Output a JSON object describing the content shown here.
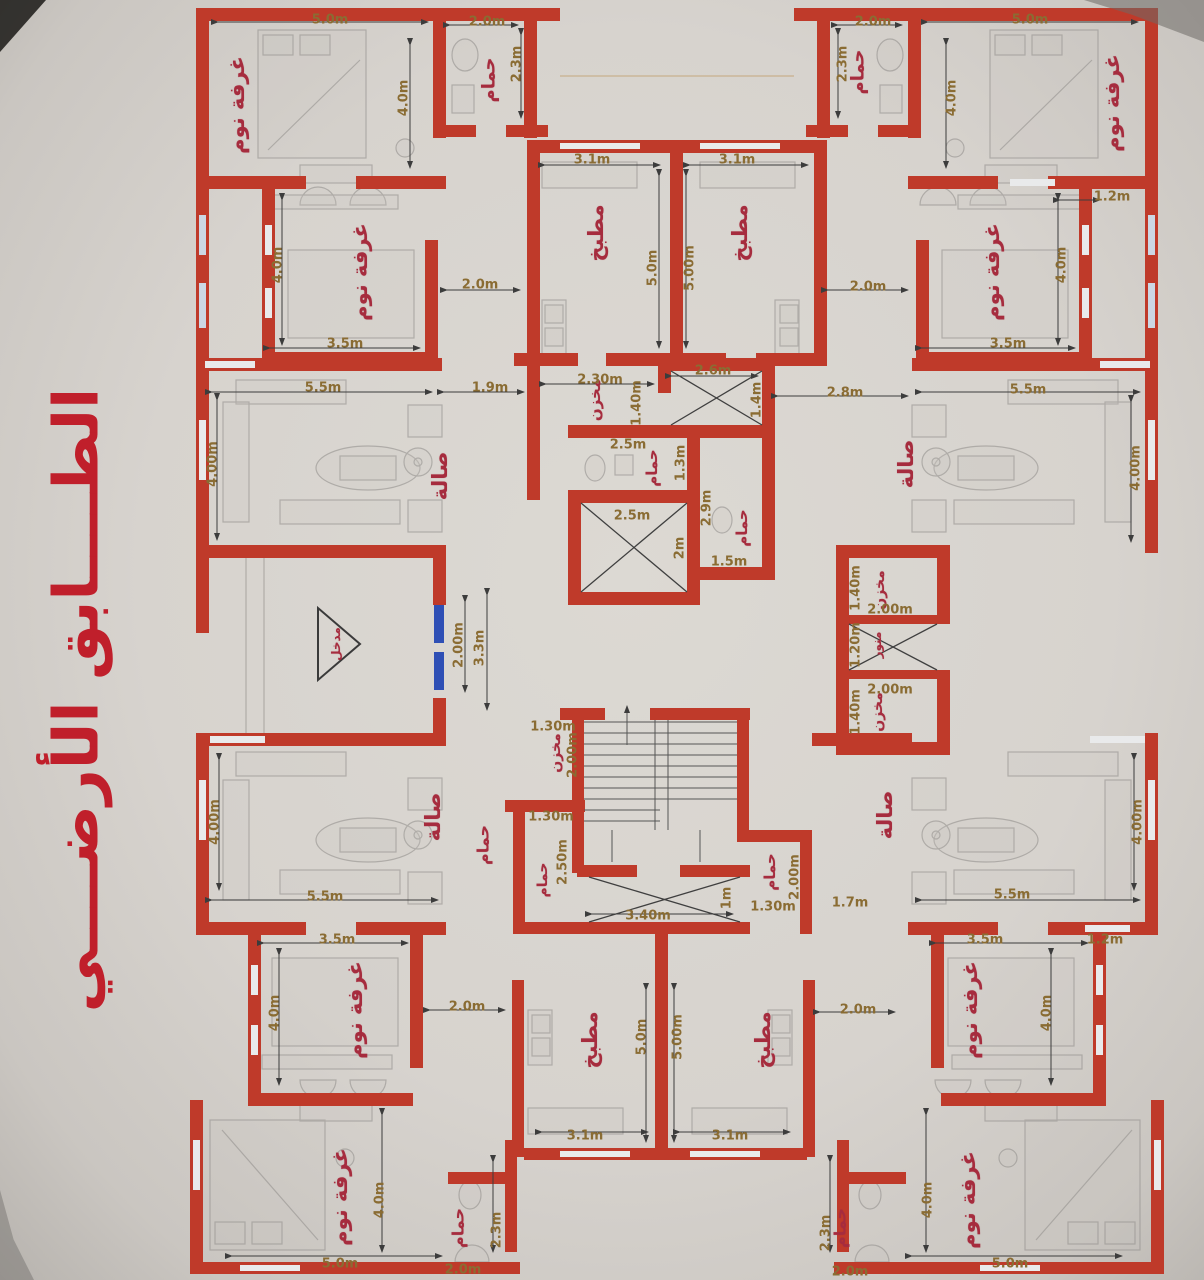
{
  "title": {
    "text": "الطــــابق الأرضــــي"
  },
  "colors": {
    "wall": "#bf3a2a",
    "room_label": "#a62c3e",
    "dim_label": "#8a6c33",
    "title": "#c01f2b",
    "door": "#2e4fb5",
    "paper": "#d7d3ce"
  },
  "rooms": [
    {
      "t": "غرفة نوم",
      "x": 237,
      "y": 105,
      "r": -90
    },
    {
      "t": "حمام",
      "x": 489,
      "y": 80,
      "r": -90,
      "s": 18
    },
    {
      "t": "غرفة نوم",
      "x": 360,
      "y": 272,
      "r": -90
    },
    {
      "t": "مطبخ",
      "x": 596,
      "y": 233,
      "r": -90
    },
    {
      "t": "مطبخ",
      "x": 740,
      "y": 233,
      "r": -90
    },
    {
      "t": "حمام",
      "x": 858,
      "y": 72,
      "r": -90,
      "s": 18
    },
    {
      "t": "غرفة نوم",
      "x": 1112,
      "y": 103,
      "r": -90
    },
    {
      "t": "غرفة نوم",
      "x": 992,
      "y": 272,
      "r": -90
    },
    {
      "t": "صالة",
      "x": 440,
      "y": 476,
      "r": -90
    },
    {
      "t": "صالة",
      "x": 906,
      "y": 464,
      "r": -90
    },
    {
      "t": "مخزن",
      "x": 595,
      "y": 400,
      "r": -90,
      "s": 15
    },
    {
      "t": "حمام",
      "x": 652,
      "y": 468,
      "r": -90,
      "s": 15
    },
    {
      "t": "حمام",
      "x": 742,
      "y": 528,
      "r": -90,
      "s": 15
    },
    {
      "t": "مخزن",
      "x": 880,
      "y": 590,
      "r": -90,
      "s": 14
    },
    {
      "t": "منور",
      "x": 877,
      "y": 645,
      "r": -90,
      "s": 12
    },
    {
      "t": "مخزن",
      "x": 878,
      "y": 712,
      "r": -90,
      "s": 14
    },
    {
      "t": "مدخل",
      "x": 336,
      "y": 644,
      "r": -90,
      "s": 12
    },
    {
      "t": "مخزن",
      "x": 556,
      "y": 753,
      "r": -90,
      "s": 14
    },
    {
      "t": "حمام",
      "x": 483,
      "y": 845,
      "r": -90,
      "s": 16
    },
    {
      "t": "حمام",
      "x": 543,
      "y": 880,
      "r": -90,
      "s": 14
    },
    {
      "t": "حمام",
      "x": 770,
      "y": 872,
      "r": -90,
      "s": 15
    },
    {
      "t": "صالة",
      "x": 433,
      "y": 817,
      "r": -90
    },
    {
      "t": "صالة",
      "x": 885,
      "y": 815,
      "r": -90
    },
    {
      "t": "غرفة نوم",
      "x": 355,
      "y": 1010,
      "r": -90
    },
    {
      "t": "غرفة نوم",
      "x": 970,
      "y": 1010,
      "r": -90
    },
    {
      "t": "مطبخ",
      "x": 590,
      "y": 1040,
      "r": -90
    },
    {
      "t": "مطبخ",
      "x": 763,
      "y": 1040,
      "r": -90
    },
    {
      "t": "غرفة نوم",
      "x": 340,
      "y": 1197,
      "r": -90
    },
    {
      "t": "غرفة نوم",
      "x": 968,
      "y": 1200,
      "r": -90
    },
    {
      "t": "حمام",
      "x": 458,
      "y": 1228,
      "r": -90,
      "s": 16
    },
    {
      "t": "حمام",
      "x": 840,
      "y": 1228,
      "r": -90,
      "s": 16
    }
  ],
  "dimensions": [
    {
      "t": "5.0m",
      "x": 330,
      "y": 20,
      "r": 0
    },
    {
      "t": "2.0m",
      "x": 487,
      "y": 22,
      "r": 0
    },
    {
      "t": "2.3m",
      "x": 517,
      "y": 64,
      "r": -90
    },
    {
      "t": "4.0m",
      "x": 404,
      "y": 98,
      "r": -90
    },
    {
      "t": "2.0m",
      "x": 873,
      "y": 22,
      "r": 0
    },
    {
      "t": "5.0m",
      "x": 1030,
      "y": 20,
      "r": 0
    },
    {
      "t": "2.3m",
      "x": 843,
      "y": 64,
      "r": -90
    },
    {
      "t": "4.0m",
      "x": 952,
      "y": 98,
      "r": -90
    },
    {
      "t": "1.2m",
      "x": 1112,
      "y": 197,
      "r": 0
    },
    {
      "t": "3.1m",
      "x": 592,
      "y": 160,
      "r": 0
    },
    {
      "t": "3.1m",
      "x": 737,
      "y": 160,
      "r": 0
    },
    {
      "t": "5.0m",
      "x": 653,
      "y": 268,
      "r": -90
    },
    {
      "t": "5.00m",
      "x": 690,
      "y": 268,
      "r": -90
    },
    {
      "t": "4.0m",
      "x": 278,
      "y": 265,
      "r": -90
    },
    {
      "t": "2.0m",
      "x": 480,
      "y": 285,
      "r": 0
    },
    {
      "t": "2.0m",
      "x": 868,
      "y": 287,
      "r": 0
    },
    {
      "t": "4.0m",
      "x": 1062,
      "y": 265,
      "r": -90
    },
    {
      "t": "3.5m",
      "x": 345,
      "y": 344,
      "r": 0
    },
    {
      "t": "3.5m",
      "x": 1008,
      "y": 344,
      "r": 0
    },
    {
      "t": "5.5m",
      "x": 323,
      "y": 388,
      "r": 0
    },
    {
      "t": "1.9m",
      "x": 490,
      "y": 388,
      "r": 0
    },
    {
      "t": "2.30m",
      "x": 600,
      "y": 380,
      "r": 0
    },
    {
      "t": "1.40m",
      "x": 637,
      "y": 403,
      "r": -90
    },
    {
      "t": "2.6m",
      "x": 713,
      "y": 371,
      "r": 0
    },
    {
      "t": "1.4m",
      "x": 757,
      "y": 400,
      "r": -90
    },
    {
      "t": "2.8m",
      "x": 845,
      "y": 393,
      "r": 0
    },
    {
      "t": "5.5m",
      "x": 1028,
      "y": 390,
      "r": 0
    },
    {
      "t": "4.00m",
      "x": 213,
      "y": 464,
      "r": -90
    },
    {
      "t": "4.00m",
      "x": 1136,
      "y": 468,
      "r": -90
    },
    {
      "t": "2.5m",
      "x": 628,
      "y": 445,
      "r": 0
    },
    {
      "t": "1.3m",
      "x": 681,
      "y": 463,
      "r": -90
    },
    {
      "t": "2.9m",
      "x": 707,
      "y": 508,
      "r": -90
    },
    {
      "t": "2.5m",
      "x": 632,
      "y": 516,
      "r": 0
    },
    {
      "t": "2m",
      "x": 680,
      "y": 548,
      "r": -90
    },
    {
      "t": "1.5m",
      "x": 729,
      "y": 562,
      "r": 0
    },
    {
      "t": "1.40m",
      "x": 856,
      "y": 588,
      "r": -90
    },
    {
      "t": "2.00m",
      "x": 890,
      "y": 610,
      "r": 0
    },
    {
      "t": "1.20m",
      "x": 856,
      "y": 645,
      "r": -90
    },
    {
      "t": "2.00m",
      "x": 890,
      "y": 690,
      "r": 0
    },
    {
      "t": "1.40m",
      "x": 856,
      "y": 712,
      "r": -90
    },
    {
      "t": "2.00m",
      "x": 459,
      "y": 645,
      "r": -90
    },
    {
      "t": "3.3m",
      "x": 480,
      "y": 648,
      "r": -90
    },
    {
      "t": "1.30m",
      "x": 553,
      "y": 727,
      "r": 0
    },
    {
      "t": "2.00m",
      "x": 573,
      "y": 755,
      "r": -90
    },
    {
      "t": "1.30m",
      "x": 551,
      "y": 817,
      "r": 0
    },
    {
      "t": "2.50m",
      "x": 563,
      "y": 862,
      "r": -90
    },
    {
      "t": "3.40m",
      "x": 648,
      "y": 916,
      "r": 0
    },
    {
      "t": "1m",
      "x": 727,
      "y": 898,
      "r": -90
    },
    {
      "t": "2.00m",
      "x": 795,
      "y": 877,
      "r": -90
    },
    {
      "t": "1.30m",
      "x": 773,
      "y": 907,
      "r": 0
    },
    {
      "t": "1.7m",
      "x": 850,
      "y": 903,
      "r": 0
    },
    {
      "t": "5.5m",
      "x": 325,
      "y": 897,
      "r": 0
    },
    {
      "t": "4.00m",
      "x": 215,
      "y": 822,
      "r": -90
    },
    {
      "t": "5.5m",
      "x": 1012,
      "y": 895,
      "r": 0
    },
    {
      "t": "4.00m",
      "x": 1138,
      "y": 822,
      "r": -90
    },
    {
      "t": "3.5m",
      "x": 337,
      "y": 940,
      "r": 0
    },
    {
      "t": "3.5m",
      "x": 985,
      "y": 940,
      "r": 0
    },
    {
      "t": "4.0m",
      "x": 275,
      "y": 1013,
      "r": -90
    },
    {
      "t": "4.0m",
      "x": 1047,
      "y": 1013,
      "r": -90
    },
    {
      "t": "2.0m",
      "x": 467,
      "y": 1007,
      "r": 0
    },
    {
      "t": "2.0m",
      "x": 858,
      "y": 1010,
      "r": 0
    },
    {
      "t": "1.2m",
      "x": 1105,
      "y": 940,
      "r": 0
    },
    {
      "t": "5.0m",
      "x": 642,
      "y": 1037,
      "r": -90
    },
    {
      "t": "5.00m",
      "x": 678,
      "y": 1037,
      "r": -90
    },
    {
      "t": "3.1m",
      "x": 585,
      "y": 1136,
      "r": 0
    },
    {
      "t": "3.1m",
      "x": 730,
      "y": 1136,
      "r": 0
    },
    {
      "t": "4.0m",
      "x": 380,
      "y": 1200,
      "r": -90
    },
    {
      "t": "4.0m",
      "x": 928,
      "y": 1200,
      "r": -90
    },
    {
      "t": "5.0m",
      "x": 340,
      "y": 1264,
      "r": 0
    },
    {
      "t": "5.0m",
      "x": 1010,
      "y": 1264,
      "r": 0
    },
    {
      "t": "2.3m",
      "x": 497,
      "y": 1230,
      "r": -90
    },
    {
      "t": "2.0m",
      "x": 463,
      "y": 1270,
      "r": 0
    },
    {
      "t": "2.3m",
      "x": 826,
      "y": 1233,
      "r": -90
    },
    {
      "t": "2.0m",
      "x": 850,
      "y": 1272,
      "r": 0
    }
  ]
}
